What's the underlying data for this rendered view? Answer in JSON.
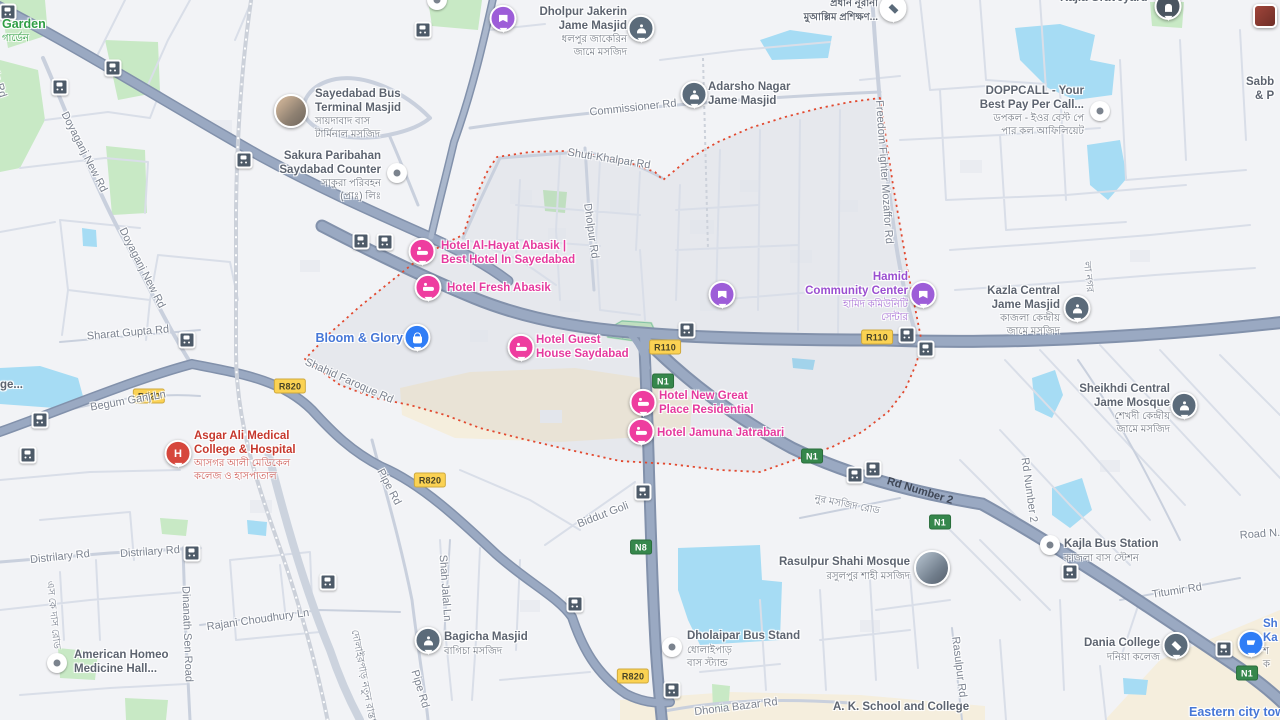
{
  "colors": {
    "land": "#f2f3f6",
    "water": "#a6dcf4",
    "park": "#c8e9c5",
    "commercial": "#f5eedd",
    "major_road": "#9aa9c2",
    "road_casing": "#8291ab",
    "minor_road": "#d9dee8",
    "boundary_red": "#e2492f",
    "hotel_pink": "#ee3d9f",
    "poi_purple": "#9d5dd8",
    "poi_blue": "#2f7df6",
    "hospital_red": "#d6473c",
    "shield_yellow": "#fbd253",
    "shield_green": "#36874c",
    "label_gray": "#5d6470"
  },
  "shields": {
    "r110": "R110",
    "r820": "R820",
    "n1": "N1",
    "n8": "N8"
  },
  "roads": {
    "doyaganj": "Doyaganj New Rd",
    "sharat": "Sharat Gupta Rd",
    "begumganj": "Begum Ganj Ln",
    "shahid": "Shahid Faroque Rd",
    "distrilary": "Distrilary Rd",
    "dinanath": "Dinanath Sen Road",
    "skdas": "এস কে দাস রোড",
    "rajani": "Rajani Choudhury Ln",
    "pipe": "Pipe Rd",
    "shahjalal": "Shah Jalal Ln",
    "notun": "দোলাইরপাড় নতুন রাস্তা",
    "biddut": "Biddut Goli",
    "dholpur": "Dholpur Rd",
    "commissioner": "Commissioner Rd",
    "shuti": "Shuti-Khalpar Rd",
    "freedom": "Freedom Fighter Mozaffor Rd",
    "rdnumber2": "Rd Number 2",
    "titumir": "Titumir Rd",
    "rasulpur_rd": "Rasulpur Rd",
    "dhonia": "Dhonia Bazar Rd",
    "roadn": "Road N...",
    "nurmasjid": "নুর মসজিদ রোড",
    "cut_left": "ida Rd",
    "nagar": "লা নগর"
  },
  "pois": {
    "garden": {
      "name": "Garden",
      "bn": "গার্ডেন"
    },
    "sayedabad": {
      "l1": "Sayedabad Bus",
      "l2": "Terminal Masjid",
      "bn1": "সায়দাবাদ বাস",
      "bn2": "টার্মিনাল মসজিদ"
    },
    "sakura": {
      "l1": "Sakura Paribahan",
      "l2": "Saydabad Counter",
      "bn1": "সাকুরা পরিবহন",
      "bn2": "(প্রাঃ) লিঃ"
    },
    "dholpur_jakerin": {
      "l1": "Dholpur Jakerin",
      "l2": "Jame Masjid",
      "bn1": "ধলপুর জাকেরিন",
      "bn2": "জামে মসজিদ"
    },
    "adarsho": {
      "l1": "Adarsho Nagar",
      "l2": "Jame Masjid"
    },
    "nurani": {
      "bn1": "প্রধান নূরানী",
      "bn2": "মুআল্লিম প্রশিক্ষণ..."
    },
    "kajla_graveyard": {
      "name": "Kajla Graveyard"
    },
    "sabb": {
      "l1": "Sabb",
      "l2": "& P"
    },
    "doppcall": {
      "l1": "DOPPCALL - Your",
      "l2": "Best Pay Per Call...",
      "bn1": "ডপকল - ইওর বেস্ট পে",
      "bn2": "পার কল আফিলিয়েট"
    },
    "alhayat": {
      "l1": "Hotel Al-Hayat Abasik |",
      "l2": "Best Hotel In Sayedabad"
    },
    "fresh": {
      "name": "Hotel Fresh Abasik"
    },
    "bloom": {
      "name": "Bloom & Glory"
    },
    "guest": {
      "l1": "Hotel Guest",
      "l2": "House Saydabad"
    },
    "hamid": {
      "l1": "Hamid",
      "l2": "Community Center",
      "bn1": "হামিদ কমিউনিটি",
      "bn2": "সেন্টার"
    },
    "kazla_central": {
      "l1": "Kazla Central",
      "l2": "Jame Masjid",
      "bn1": "কাজলা কেন্দ্রীয়",
      "bn2": "জামে মসজিদ"
    },
    "newgreat": {
      "l1": "Hotel New Great",
      "l2": "Place Residential"
    },
    "jamuna": {
      "name": "Hotel Jamuna Jatrabari"
    },
    "asgar": {
      "l1": "Asgar Ali Medical",
      "l2": "College & Hospital",
      "bn1": "আসগর আলী মেডিকেল",
      "bn2": "কলেজ ও হাসপাতাল"
    },
    "sheikhdi": {
      "l1": "Sheikhdi Central",
      "l2": "Jame Mosque",
      "bn1": "শেখদী কেন্দ্রীয়",
      "bn2": "জামে মসজিদ"
    },
    "kajla_bus": {
      "name": "Kajla Bus Station",
      "bn": "কাজলা বাস স্টেশন"
    },
    "rasulpur": {
      "name": "Rasulpur Shahi Mosque",
      "bn": "রসুলপুর শাহী মসজিদ"
    },
    "dholaipar": {
      "name": "Dholaipar Bus Stand",
      "bn1": "ধোলাইপাড়",
      "bn2": "বাস স্ট্যান্ড"
    },
    "bagicha": {
      "name": "Bagicha Masjid",
      "bn": "বাগিচা মসজিদ"
    },
    "american": {
      "l1": "American Homeo",
      "l2": "Medicine Hall..."
    },
    "dania": {
      "name": "Dania College",
      "bn": "দনিয়া কলেজ"
    },
    "shop_right": {
      "l1": "Sh",
      "l2": "Ka",
      "bn1": "শ",
      "bn2": "ক"
    },
    "eastern": {
      "name": "Eastern city towe"
    },
    "ak_school": {
      "name": "A. K. School and College"
    },
    "ge_cut": {
      "name": "ge..."
    }
  }
}
